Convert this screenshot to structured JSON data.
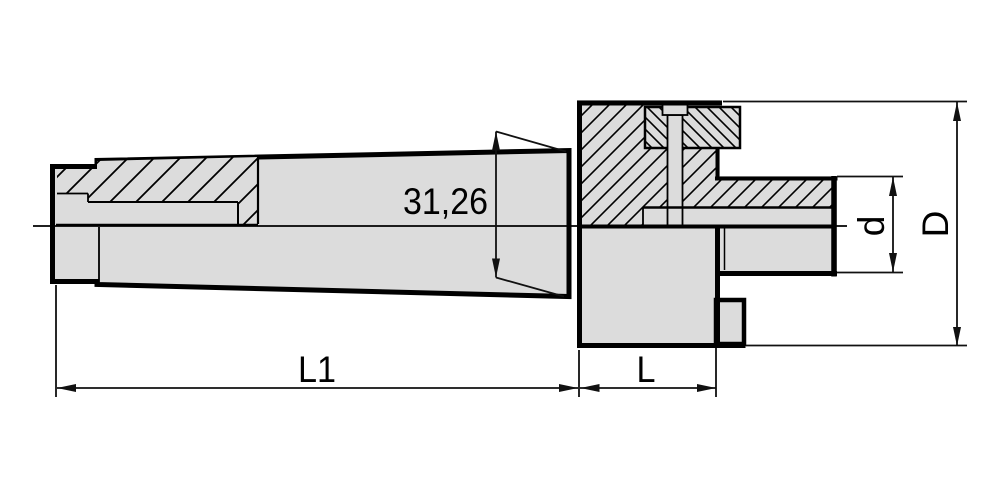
{
  "title": "Tool holder technical drawing (taper shank arbor, half-section)",
  "dimensions": {
    "taper_gauge_diameter": {
      "label": "31,26"
    },
    "shank_length": {
      "label": "L1"
    },
    "head_length": {
      "label": "L"
    },
    "arbor_seat_diameter": {
      "label": "d"
    },
    "flange_diameter": {
      "label": "D"
    }
  },
  "colors": {
    "part_fill": "#dcdcdc",
    "outline": "#000000",
    "dimension_line": "#111111",
    "background": "#ffffff"
  }
}
